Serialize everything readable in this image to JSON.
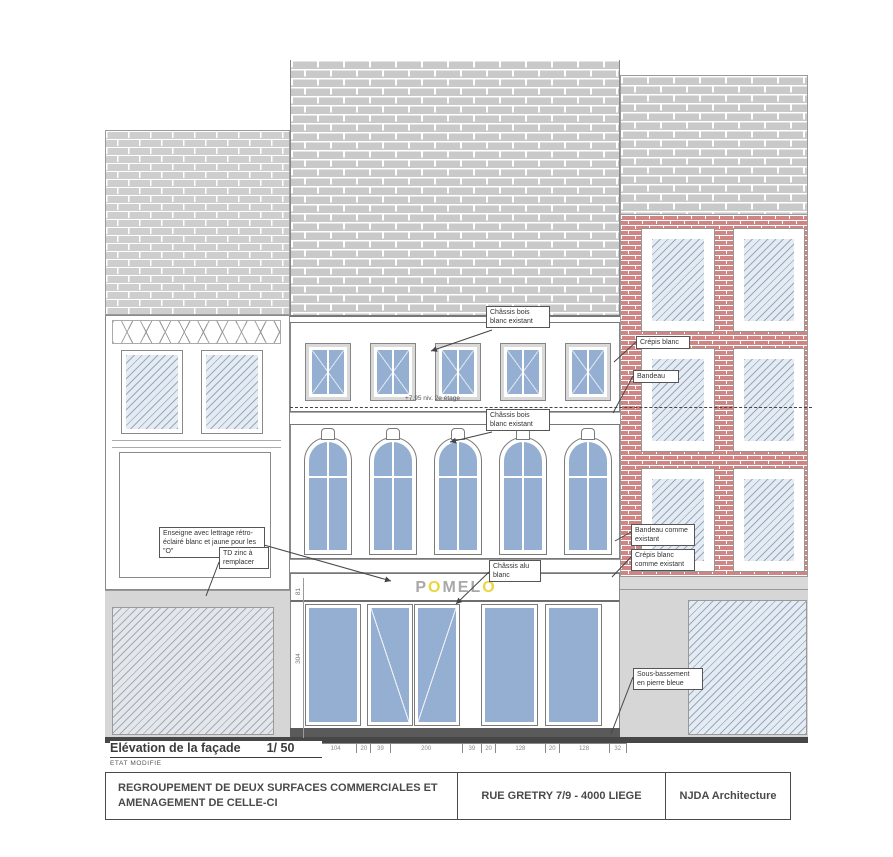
{
  "annotations": {
    "chassis_bois_2e": "Châssis bois blanc existant",
    "chassis_bois_1er": "Châssis bois blanc existant",
    "crepis_blanc": "Crépis blanc",
    "bandeau": "Bandeau",
    "enseigne": "Enseigne avec lettrage rétro-éclairé blanc et jaune pour les \"O\"",
    "td_zinc": "TD zinc à remplacer",
    "bandeau_existant": "Bandeau comme existant",
    "crepis_existant": "Crépis blanc comme existant",
    "chassis_alu": "Châssis alu blanc",
    "sous_bassement": "Sous-bassement en pierre bleue",
    "niveau": "+7.95 niv. 2e étage"
  },
  "sign": {
    "text": "POMELO",
    "yellow_letter": "O",
    "yellow_color": "#e9d63f"
  },
  "dimensions": {
    "horizontal": [
      53,
      104,
      20,
      39,
      200,
      39,
      20,
      128,
      20,
      128,
      32
    ],
    "vertical": [
      "81",
      "304"
    ]
  },
  "footer": {
    "view_title": "Elévation de la façade",
    "scale": "1/ 50",
    "status": "ETAT MODIFIE",
    "project": "REGROUPEMENT DE DEUX SURFACES COMMERCIALES ET AMENAGEMENT DE CELLE-CI",
    "address": "RUE GRETRY 7/9 - 4000 LIEGE",
    "firm": "NJDA Architecture"
  },
  "colors": {
    "glass_blue": "#94afd1",
    "hatch_blue_bg": "#e5ebf2",
    "brick_gray": "#c9c9c9",
    "brick_red": "#d08585",
    "ground_gray": "#d6d6d6",
    "base_dark": "#4f4f4f"
  }
}
